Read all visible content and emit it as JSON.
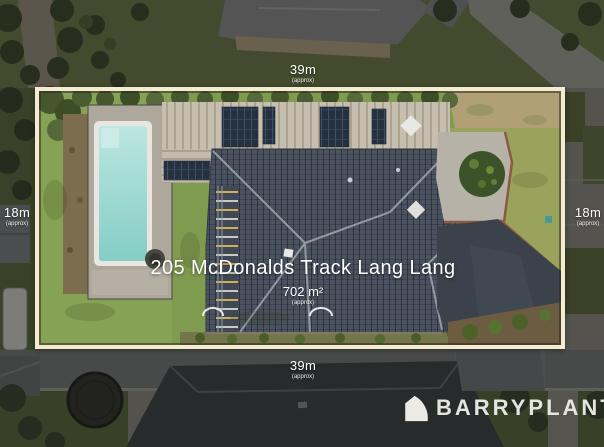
{
  "dimensions": {
    "top": {
      "value": "39m",
      "approx": "(approx)"
    },
    "bottom": {
      "value": "39m",
      "approx": "(approx)"
    },
    "left": {
      "value": "18m",
      "approx": "(approx)"
    },
    "right": {
      "value": "18m",
      "approx": "(approx)"
    }
  },
  "property": {
    "address": "205 McDonalds Track Lang Lang",
    "area": "702 m²",
    "area_approx": "(approx)"
  },
  "branding": {
    "name": "BARRYPLANT"
  },
  "colors": {
    "boundary_line": "#f3ebd2",
    "label_text": "#ffffff",
    "pool_water": "#8ed2cb",
    "main_roof": "#4a535f",
    "back_roof": "#c6beaf",
    "lawn": "#7f9b50",
    "right_lawn": "#99a35c",
    "driveway": "#3b424b",
    "brand_text": "#e6e4df"
  }
}
